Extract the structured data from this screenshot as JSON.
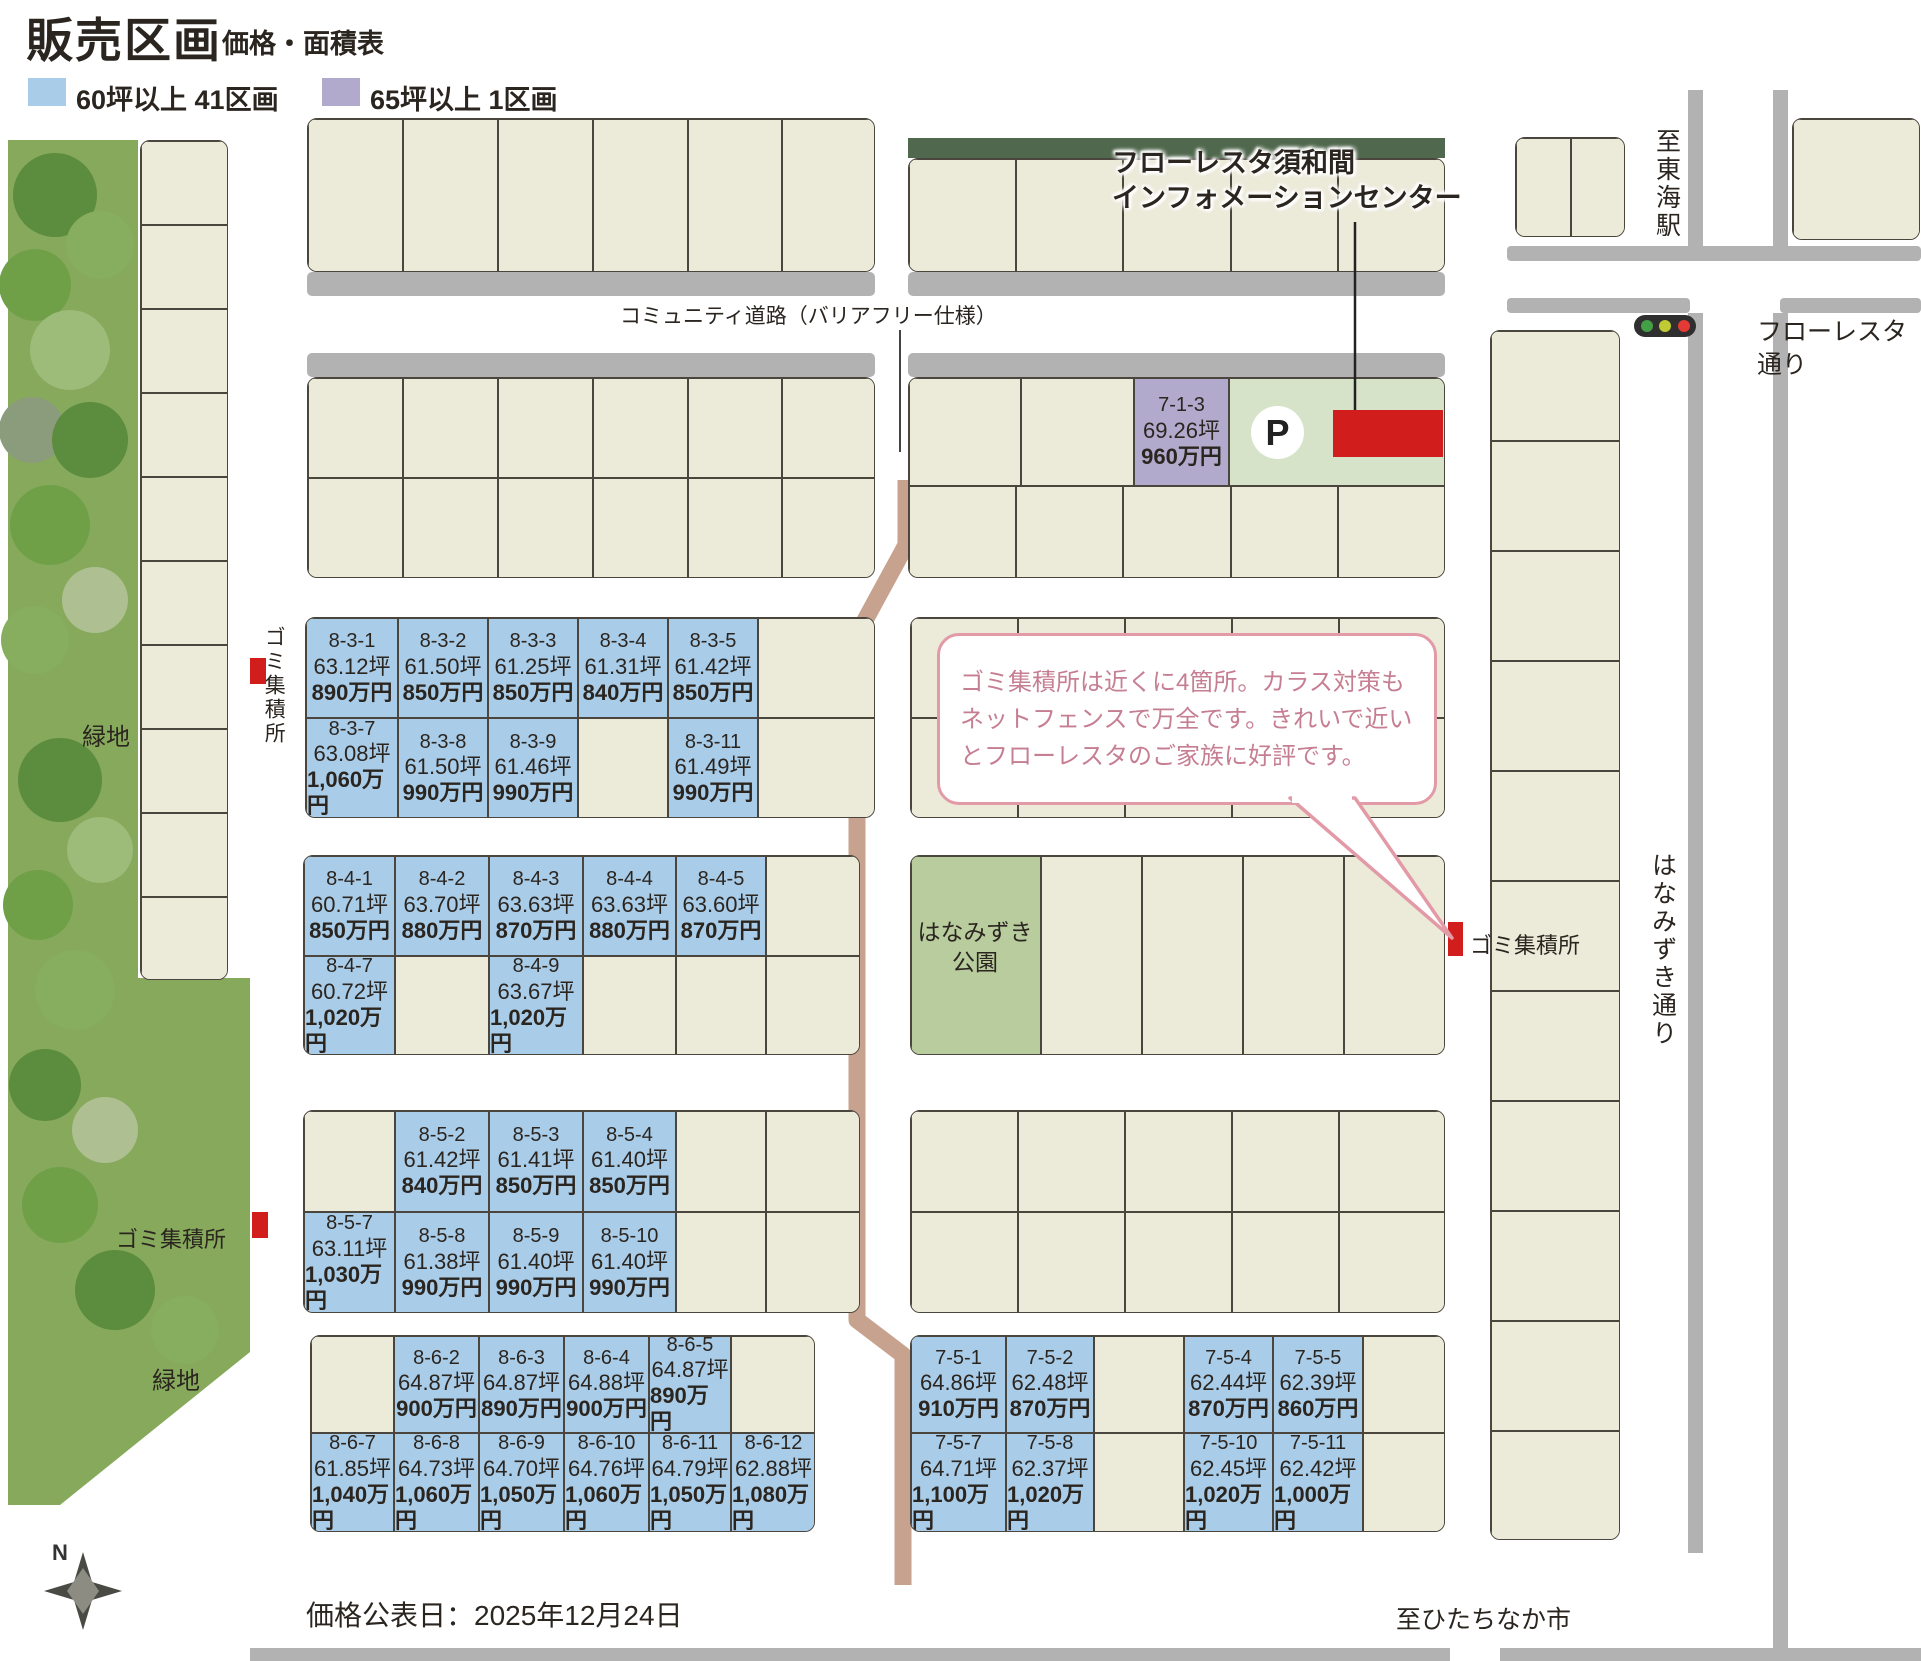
{
  "title": {
    "main": "販売区画",
    "sub": "価格・面積表"
  },
  "legend": [
    {
      "label": "60坪以上 41区画",
      "color": "#a9cce8"
    },
    {
      "label": "65坪以上  1区画",
      "color": "#b2aacd"
    }
  ],
  "colors": {
    "blue": "#a9cce8",
    "purple": "#b2aacd",
    "beige": "#ecead9",
    "park": "#b8cc9e",
    "plot": "#d7e3c9",
    "red": "#d21d1d",
    "casing": "#b2b2b2",
    "hedge": "#50684d",
    "path_tan": "#c7a28e",
    "bubble_border": "#e39aa7",
    "bubble_text": "#c67e92",
    "green": "#86a95c"
  },
  "bubble": {
    "text": "ゴミ集積所は近くに4箇所。カラス対策も\nネットフェンスで万全です。きれいで近い\nとフローレスタのご家族に好評です。"
  },
  "parking_label": "P",
  "compass_label": "N",
  "map_labels": [
    {
      "n": "info-center-label",
      "t": "フローレスタ須和間\nインフォメーションセンター",
      "x": 1112,
      "y": 146,
      "s": 27,
      "b": 1,
      "halo": 1
    },
    {
      "n": "community-road-label",
      "t": "コミュニティ道路（バリアフリー仕様）",
      "x": 620,
      "y": 303,
      "s": 21
    },
    {
      "n": "to-tokai-station-label",
      "t": "至東海駅",
      "x": 1650,
      "y": 128,
      "s": 25,
      "v": 1
    },
    {
      "n": "floresta-street-label",
      "t": "フローレスタ通り",
      "x": 1757,
      "y": 316,
      "s": 25
    },
    {
      "n": "hanamizuki-street-label",
      "t": "はなみずき通り",
      "x": 1646,
      "y": 852,
      "s": 25,
      "v": 1
    },
    {
      "n": "green-area-label-1",
      "t": "緑地",
      "x": 82,
      "y": 722,
      "s": 24
    },
    {
      "n": "green-area-label-2",
      "t": "緑地",
      "x": 152,
      "y": 1366,
      "s": 24
    },
    {
      "n": "garbage-station-label-1",
      "t": "ゴミ集積所",
      "x": 260,
      "y": 626,
      "s": 21,
      "v": 1
    },
    {
      "n": "garbage-station-label-2",
      "t": "ゴミ集積所",
      "x": 116,
      "y": 1226,
      "s": 22
    },
    {
      "n": "garbage-station-label-3",
      "t": "ゴミ集積所",
      "x": 1470,
      "y": 932,
      "s": 22
    },
    {
      "n": "hanamizuki-park-label",
      "t": "はなみずき\n公園",
      "x": 910,
      "y": 918,
      "s": 23,
      "ctr": 130
    },
    {
      "n": "price-release-date",
      "t": "価格公表日：2025年12月24日",
      "x": 306,
      "y": 1598,
      "s": 28
    },
    {
      "n": "to-hitachinaka-label",
      "t": "至ひたちなか市",
      "x": 1396,
      "y": 1604,
      "s": 25
    }
  ],
  "blocks": [
    {
      "name": "strip-top-left",
      "x": 307,
      "y": 118,
      "colw": [
        95,
        95,
        95,
        95,
        94,
        94
      ],
      "rows": [
        {
          "h": 154,
          "cells": [
            {},
            {},
            {},
            {},
            {},
            {}
          ]
        }
      ]
    },
    {
      "name": "strip-top-right",
      "x": 908,
      "y": 158,
      "colw": [
        107,
        107,
        108,
        107,
        108
      ],
      "rows": [
        {
          "h": 114,
          "cells": [
            {},
            {},
            {},
            {},
            {}
          ]
        }
      ]
    },
    {
      "name": "strip-corner-ne1",
      "x": 1515,
      "y": 137,
      "colw": [
        55,
        55
      ],
      "rows": [
        {
          "h": 100,
          "cells": [
            {},
            {}
          ]
        }
      ]
    },
    {
      "name": "strip-corner-ne2",
      "x": 1792,
      "y": 118,
      "colw": [
        128
      ],
      "rows": [
        {
          "h": 122,
          "cells": [
            {}
          ]
        }
      ]
    },
    {
      "name": "strip-row-b-left",
      "x": 307,
      "y": 377,
      "colw": [
        95,
        95,
        95,
        95,
        94,
        94
      ],
      "rows": [
        {
          "h": 100,
          "cells": [
            {},
            {},
            {},
            {},
            {},
            {}
          ]
        },
        {
          "h": 101,
          "cells": [
            {},
            {},
            {},
            {},
            {},
            {}
          ]
        }
      ]
    },
    {
      "name": "strip-row-b-right",
      "x": 908,
      "y": 377,
      "colw": [
        112,
        113,
        95,
        217
      ],
      "rows": [
        {
          "h": 108,
          "cells": [
            {},
            {},
            {
              "id": "7-1-3",
              "area": "69.26坪",
              "price": "960万円",
              "fill": "purple"
            },
            {
              "fill": "plot"
            }
          ]
        },
        {
          "h": 93,
          "colw": [
            107,
            107,
            108,
            107,
            108
          ],
          "cells": [
            {},
            {},
            {},
            {},
            {}
          ]
        }
      ]
    },
    {
      "name": "block-8-3",
      "x": 305,
      "y": 617,
      "colw": [
        92,
        90,
        90,
        90,
        90,
        118
      ],
      "rows": [
        {
          "h": 100,
          "cells": [
            {
              "id": "8-3-1",
              "area": "63.12坪",
              "price": "890万円"
            },
            {
              "id": "8-3-2",
              "area": "61.50坪",
              "price": "850万円"
            },
            {
              "id": "8-3-3",
              "area": "61.25坪",
              "price": "850万円"
            },
            {
              "id": "8-3-4",
              "area": "61.31坪",
              "price": "840万円"
            },
            {
              "id": "8-3-5",
              "area": "61.42坪",
              "price": "850万円"
            },
            {}
          ]
        },
        {
          "h": 101,
          "cells": [
            {
              "id": "8-3-7",
              "area": "63.08坪",
              "price": "1,060万円"
            },
            {
              "id": "8-3-8",
              "area": "61.50坪",
              "price": "990万円"
            },
            {
              "id": "8-3-9",
              "area": "61.46坪",
              "price": "990万円"
            },
            {},
            {
              "id": "8-3-11",
              "area": "61.49坪",
              "price": "990万円"
            },
            {}
          ]
        }
      ]
    },
    {
      "name": "strip-mid-right-1",
      "x": 910,
      "y": 617,
      "colw": [
        107,
        107,
        107,
        107,
        107
      ],
      "rows": [
        {
          "h": 100,
          "cells": [
            {},
            {},
            {},
            {},
            {}
          ]
        },
        {
          "h": 101,
          "cells": [
            {},
            {},
            {},
            {},
            {}
          ]
        }
      ]
    },
    {
      "name": "block-8-4",
      "x": 303,
      "y": 855,
      "colw": [
        91,
        94,
        94,
        93,
        90,
        95
      ],
      "rows": [
        {
          "h": 100,
          "cells": [
            {
              "id": "8-4-1",
              "area": "60.71坪",
              "price": "850万円"
            },
            {
              "id": "8-4-2",
              "area": "63.70坪",
              "price": "880万円"
            },
            {
              "id": "8-4-3",
              "area": "63.63坪",
              "price": "870万円"
            },
            {
              "id": "8-4-4",
              "area": "63.63坪",
              "price": "880万円"
            },
            {
              "id": "8-4-5",
              "area": "63.60坪",
              "price": "870万円"
            },
            {}
          ]
        },
        {
          "h": 100,
          "cells": [
            {
              "id": "8-4-7",
              "area": "60.72坪",
              "price": "1,020万円"
            },
            {},
            {
              "id": "8-4-9",
              "area": "63.67坪",
              "price": "1,020万円"
            },
            {},
            {},
            {}
          ]
        }
      ]
    },
    {
      "name": "strip-park-row",
      "x": 910,
      "y": 855,
      "colw": [
        130,
        101,
        101,
        101,
        102
      ],
      "rows": [
        {
          "h": 200,
          "cells": [
            {
              "fill": "park"
            },
            {},
            {},
            {},
            {}
          ]
        }
      ]
    },
    {
      "name": "block-8-5",
      "x": 303,
      "y": 1110,
      "colw": [
        91,
        94,
        94,
        93,
        90,
        95
      ],
      "rows": [
        {
          "h": 101,
          "cells": [
            {},
            {
              "id": "8-5-2",
              "area": "61.42坪",
              "price": "840万円"
            },
            {
              "id": "8-5-3",
              "area": "61.41坪",
              "price": "850万円"
            },
            {
              "id": "8-5-4",
              "area": "61.40坪",
              "price": "850万円"
            },
            {},
            {}
          ]
        },
        {
          "h": 102,
          "cells": [
            {
              "id": "8-5-7",
              "area": "63.11坪",
              "price": "1,030万円"
            },
            {
              "id": "8-5-8",
              "area": "61.38坪",
              "price": "990万円"
            },
            {
              "id": "8-5-9",
              "area": "61.40坪",
              "price": "990万円"
            },
            {
              "id": "8-5-10",
              "area": "61.40坪",
              "price": "990万円"
            },
            {},
            {}
          ]
        }
      ]
    },
    {
      "name": "strip-mid-right-2",
      "x": 910,
      "y": 1110,
      "colw": [
        107,
        107,
        107,
        107,
        107
      ],
      "rows": [
        {
          "h": 101,
          "cells": [
            {},
            {},
            {},
            {},
            {}
          ]
        },
        {
          "h": 102,
          "cells": [
            {},
            {},
            {},
            {},
            {}
          ]
        }
      ]
    },
    {
      "name": "block-8-6",
      "x": 310,
      "y": 1335,
      "colw": [
        83,
        85,
        85,
        85,
        82,
        85
      ],
      "rows": [
        {
          "h": 97,
          "cells": [
            {},
            {
              "id": "8-6-2",
              "area": "64.87坪",
              "price": "900万円"
            },
            {
              "id": "8-6-3",
              "area": "64.87坪",
              "price": "890万円"
            },
            {
              "id": "8-6-4",
              "area": "64.88坪",
              "price": "900万円"
            },
            {
              "id": "8-6-5",
              "area": "64.87坪",
              "price": "890万円"
            },
            {}
          ]
        },
        {
          "h": 100,
          "cells": [
            {
              "id": "8-6-7",
              "area": "61.85坪",
              "price": "1,040万円"
            },
            {
              "id": "8-6-8",
              "area": "64.73坪",
              "price": "1,060万円"
            },
            {
              "id": "8-6-9",
              "area": "64.70坪",
              "price": "1,050万円"
            },
            {
              "id": "8-6-10",
              "area": "64.76坪",
              "price": "1,060万円"
            },
            {
              "id": "8-6-11",
              "area": "64.79坪",
              "price": "1,050万円"
            },
            {
              "id": "8-6-12",
              "area": "62.88坪",
              "price": "1,080万円"
            }
          ]
        }
      ]
    },
    {
      "name": "block-7-5",
      "x": 910,
      "y": 1335,
      "colw": [
        95,
        88,
        90,
        89,
        90,
        83
      ],
      "rows": [
        {
          "h": 97,
          "cells": [
            {
              "id": "7-5-1",
              "area": "64.86坪",
              "price": "910万円"
            },
            {
              "id": "7-5-2",
              "area": "62.48坪",
              "price": "870万円"
            },
            {},
            {
              "id": "7-5-4",
              "area": "62.44坪",
              "price": "870万円"
            },
            {
              "id": "7-5-5",
              "area": "62.39坪",
              "price": "860万円"
            },
            {}
          ]
        },
        {
          "h": 100,
          "cells": [
            {
              "id": "7-5-7",
              "area": "64.71坪",
              "price": "1,100万円"
            },
            {
              "id": "7-5-8",
              "area": "62.37坪",
              "price": "1,020万円"
            },
            {},
            {
              "id": "7-5-10",
              "area": "62.45坪",
              "price": "1,020万円"
            },
            {
              "id": "7-5-11",
              "area": "62.42坪",
              "price": "1,000万円"
            },
            {}
          ]
        }
      ]
    },
    {
      "name": "strip-right-column",
      "x": 1490,
      "y": 330,
      "colw": [
        130
      ],
      "rows": [
        {
          "h": 110,
          "cells": [
            {}
          ]
        },
        {
          "h": 110,
          "cells": [
            {}
          ]
        },
        {
          "h": 110,
          "cells": [
            {}
          ]
        },
        {
          "h": 110,
          "cells": [
            {}
          ]
        },
        {
          "h": 110,
          "cells": [
            {}
          ]
        },
        {
          "h": 110,
          "cells": [
            {}
          ]
        },
        {
          "h": 110,
          "cells": [
            {}
          ]
        },
        {
          "h": 110,
          "cells": [
            {}
          ]
        },
        {
          "h": 110,
          "cells": [
            {}
          ]
        },
        {
          "h": 110,
          "cells": [
            {}
          ]
        },
        {
          "h": 110,
          "cells": [
            {}
          ]
        }
      ]
    },
    {
      "name": "strip-left-column",
      "x": 140,
      "y": 140,
      "colw": [
        88
      ],
      "rows": [
        {
          "h": 84,
          "cells": [
            {}
          ]
        },
        {
          "h": 84,
          "cells": [
            {}
          ]
        },
        {
          "h": 84,
          "cells": [
            {}
          ]
        },
        {
          "h": 84,
          "cells": [
            {}
          ]
        },
        {
          "h": 84,
          "cells": [
            {}
          ]
        },
        {
          "h": 84,
          "cells": [
            {}
          ]
        },
        {
          "h": 84,
          "cells": [
            {}
          ]
        },
        {
          "h": 84,
          "cells": [
            {}
          ]
        },
        {
          "h": 84,
          "cells": [
            {}
          ]
        },
        {
          "h": 84,
          "cells": [
            {}
          ]
        }
      ]
    }
  ]
}
